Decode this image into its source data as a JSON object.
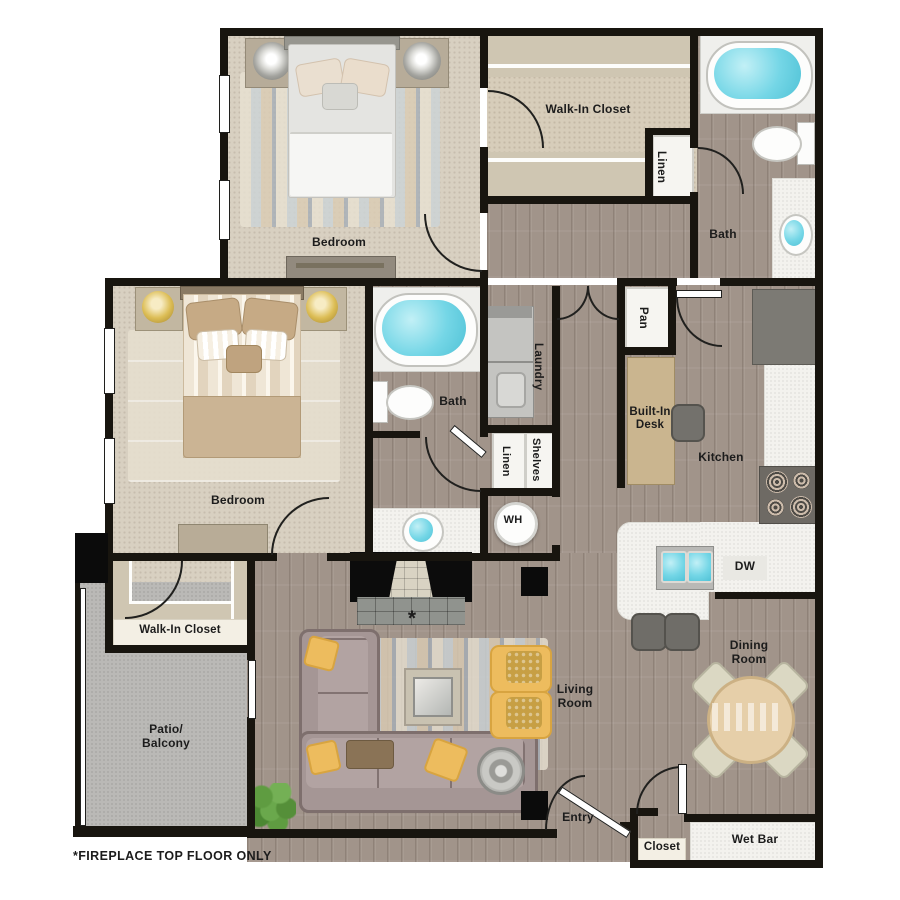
{
  "plan": {
    "footnote": "*FIREPLACE TOP FLOOR ONLY",
    "fireplace_asterisk": "*",
    "labels": {
      "bedroom_top": "Bedroom",
      "walk_in_closet_top": "Walk-In Closet",
      "linen_top": "Linen",
      "bath_top": "Bath",
      "bedroom_master": "Bedroom",
      "bath_master": "Bath",
      "laundry": "Laundry",
      "linen_mid": "Linen",
      "shelves": "Shelves",
      "water_heater": "WH",
      "pantry": "Pan",
      "built_in_desk": "Built-In Desk",
      "kitchen": "Kitchen",
      "dishwasher": "DW",
      "walk_in_closet_bottom": "Walk-In Closet",
      "patio_line1": "Patio/",
      "patio_line2": "Balcony",
      "living_room": "Living Room",
      "dining_room": "Dining Room",
      "entry": "Entry",
      "closet": "Closet",
      "wet_bar": "Wet Bar"
    },
    "colors": {
      "wall": "#18150f",
      "carpet": "#d8d0c1",
      "wood_floor": "#a1948a",
      "patio_concrete": "#bab9b6",
      "tub_water": "#74d6e6",
      "accent_gold": "#edbc5e",
      "sofa": "#a59695"
    }
  }
}
